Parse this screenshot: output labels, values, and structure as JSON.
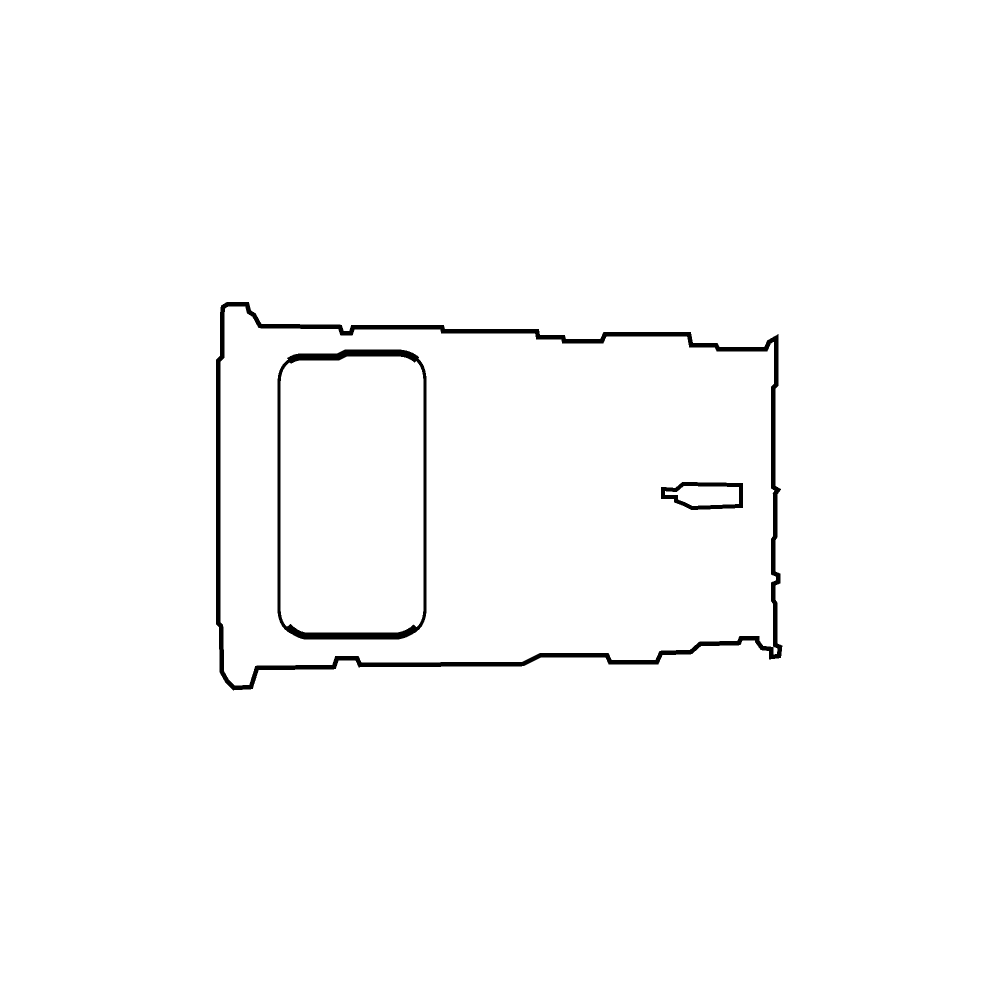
{
  "canvas": {
    "width": 1000,
    "height": 1000,
    "background_color": "#ffffff",
    "line_color": "#000000"
  },
  "figure": {
    "description": "Black outline line drawing of a SIM card tray seen from above: irregular rectangular tray body with flanged left end, a bold rounded-rectangle card slot on the left, and a small pointed latch notch on the right.",
    "shapes": [
      {
        "name": "tray-outer-outline",
        "kind": "closed-path",
        "stroke_width": 4.5,
        "d": "M 222 317 L 223 307 L 228 304 L 247 304 L 249 312 L 254 315 L 260 326 L 340 327 L 342 333 L 351 333 L 353 327 L 442 327 L 443 331 L 537 331 L 538 337 L 563 337 L 564 341 L 602 341 L 605 334 L 689 334 L 691 345 L 716 345 L 718 349 L 766 349 L 769 342 L 776 338 L 776 385 L 773 388 L 773 487 L 778 490 L 775 494 L 775 537 L 773 540 L 773 573 L 778 575 L 778 582 L 773 584 L 773 600 L 775 603 L 775 645 L 780 647 L 779 656 L 771 657 L 771 649 L 762 648 L 757 641 L 757 638 L 741 638 L 739 643 L 700 644 L 691 652 L 661 653 L 657 662 L 610 662 L 607 655 L 541 655 L 523 664 L 360 665 L 357 658 L 337 658 L 334 667 L 257 668 L 251 687 L 234 688 L 227 681 L 222 672 L 221 626 L 218 623 L 218 361 L 222 357 Z"
      },
      {
        "name": "sim-slot-outline",
        "kind": "closed-path",
        "stroke_width": 3.2,
        "d": "M 300 357 L 338 357 L 346 353 L 398 353 Q 425 354 425 382 L 425 608 Q 425 633 400 636 L 306 636 Q 279 634 279 608 L 279 384 Q 279 360 300 357 Z"
      },
      {
        "name": "sim-slot-top-edge-thick",
        "kind": "open-path",
        "stroke_width": 7,
        "d": "M 289 361 Q 295 357 301 357 L 338 357 L 346 353 L 397 353 Q 409 353 417 360"
      },
      {
        "name": "sim-slot-bottom-edge-thick",
        "kind": "open-path",
        "stroke_width": 7,
        "d": "M 288 626 Q 295 634 305 636 L 398 636 Q 409 634 416 627"
      },
      {
        "name": "latch-notch-outline",
        "kind": "closed-path",
        "stroke_width": 4,
        "d": "M 683 484 L 741 485 L 741 506 L 692 508 L 684 504 L 676 501 L 676 497 L 663 497 L 663 489 L 676 490 Z"
      }
    ]
  }
}
